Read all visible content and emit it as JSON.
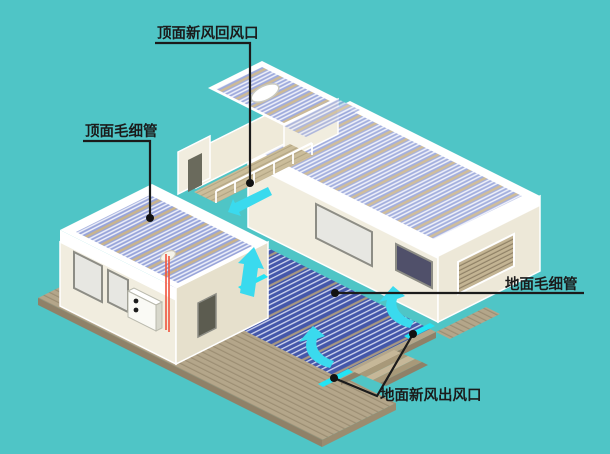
{
  "diagram": {
    "type": "isometric-house-hvac-cutaway",
    "background_color": "#4FC5C6",
    "annotations": [
      {
        "id": "ceiling-return-vent",
        "text": "顶面新风回风口"
      },
      {
        "id": "ceiling-capillary",
        "text": "顶面毛细管"
      },
      {
        "id": "floor-capillary",
        "text": "地面毛细管"
      },
      {
        "id": "floor-supply-vent",
        "text": "地面新风出风口"
      }
    ],
    "colors": {
      "background": "#4FC5C6",
      "floor_capillary_mat": "#4457AA",
      "ceiling_capillary_mat": "#97A4DA",
      "airflow_arrow": "#3ADAEE",
      "vent_strip": "#22E4F4",
      "wall": "#F1EDDF",
      "wall_shaded": "#E6E0CC",
      "deck_wood": "#B4A68A",
      "pipe_red": "#F0523C",
      "leader_line": "#1B1B1B"
    }
  }
}
